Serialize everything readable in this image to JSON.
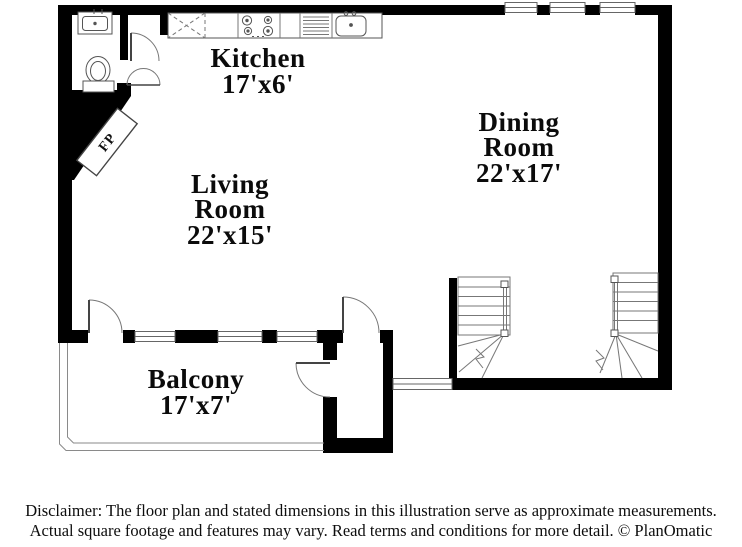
{
  "plan": {
    "rooms": [
      {
        "name": "Kitchen",
        "dims": "17'x6'"
      },
      {
        "name": "Dining Room",
        "dims": "22'x17'"
      },
      {
        "name": "Living Room",
        "dims": "22'x15'"
      },
      {
        "name": "Balcony",
        "dims": "17'x7'"
      }
    ],
    "fireplace_label": "FP"
  },
  "disclaimer": {
    "line1": "Disclaimer: The floor plan and stated dimensions in this illustration serve as approximate measurements.",
    "line2": "Actual square footage and features may vary. Read terms and conditions for more detail. © PlanOmatic"
  },
  "colors": {
    "wall": "#000000",
    "thin_line": "#777777",
    "background": "#ffffff"
  }
}
